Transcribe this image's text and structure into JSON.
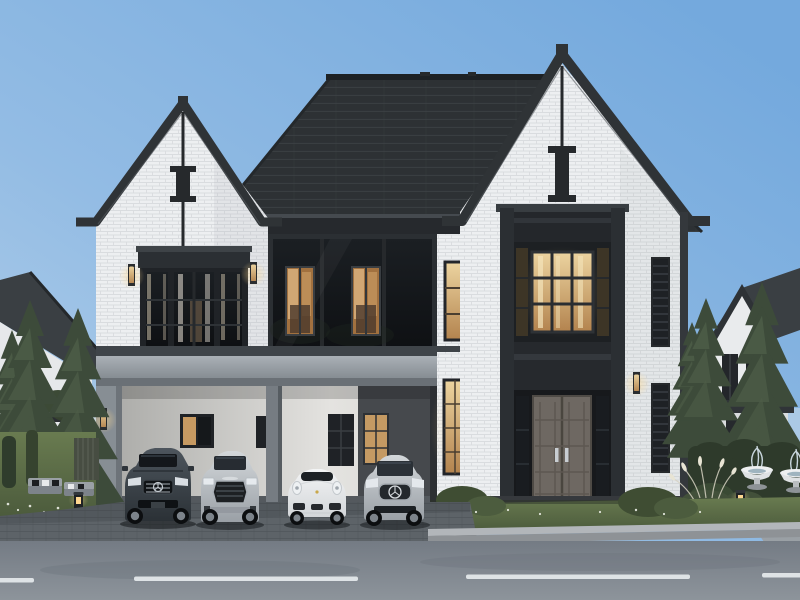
{
  "meta": {
    "description": "Dusk photorealistic 3D exterior rendering of a modern two-story luxury house with white brick walls, charcoal gabled roofs, a glass-walled upper middle section, a lit double-height entrance, and a carport sheltering four cars, fronted by an asphalt road with dashed lane markings",
    "time_of_day": "dusk",
    "render_style": "photorealistic architectural visualization"
  },
  "palette": {
    "sky_light": "#b9d3ea",
    "sky_deep": "#74a9dd",
    "roof": "#2d3134",
    "roof_course": "#3c4145",
    "trim": "#2f3336",
    "brick": "#edeff1",
    "mortar": "#d9dcdf",
    "glass_dark": "#15181c",
    "warm_light": "#d9ae74",
    "warm_bright": "#f0d9a6",
    "fascia": "#9ba1a7",
    "concrete": "#878e94",
    "carport_wall": "#d8d7d4",
    "door": "#6e6862",
    "grass": "#5f7048",
    "grass_dark": "#44533a",
    "pine": "#3d4b3a",
    "pine_light": "#4e5e48",
    "hedge": "#2e3a2b",
    "paver": "#5d6368",
    "road_top": "#747b84",
    "road_bottom": "#8d949b",
    "curb": "#b2b6ba",
    "lane_marking": "#e6eaed",
    "car_dark_gray": "#394046",
    "car_silver": "#b9bec3",
    "car_white": "#e9ebec"
  },
  "scene": {
    "sky": {
      "condition": "clear dusk sky, deeper blue toward upper right"
    },
    "main_house": {
      "floors": 2,
      "walls": "white brick",
      "roof": "charcoal shingle hip roof with two front-facing gables",
      "gable_ornament": "dark vertical post with I-shaped block under each gable peak",
      "upper_middle": "dark glass curtain wall with two warmly lit interior windows",
      "wall_sconces_lit": 6
    },
    "entrance": {
      "style": "double-height gable bay",
      "transom_window": "warm-lit 3x3 grid window",
      "door": "gray paneled double door",
      "handles": 2,
      "sidelights": 2
    },
    "carport": {
      "bays": 4,
      "structure": "flat gray fascia on concrete pillars",
      "back_wall": "light wall with dark-framed windows, darker recess on right"
    },
    "cars": [
      {
        "position": 1,
        "type": "SUV",
        "badge": "three-pointed star",
        "color": "dark gray"
      },
      {
        "position": 2,
        "type": "SUV",
        "badge": "four rings",
        "color": "silver"
      },
      {
        "position": 3,
        "type": "sports coupe",
        "badge": "crest",
        "color": "white"
      },
      {
        "position": 4,
        "type": "hatchback",
        "badge": "three-pointed star",
        "color": "silver"
      }
    ],
    "landscape": {
      "left_garden": [
        "spruce trees",
        "small leafy tree",
        "slatted screen",
        "two outdoor sofas with pillows",
        "bollard light",
        "white flowers in grass"
      ],
      "right_garden": [
        "clipped hedges",
        "two white bowl fountains with jets",
        "ornamental grass plumes",
        "bollard light",
        "spruce trees",
        "stone path"
      ],
      "foreground": [
        "paver driveway",
        "lawn strip with shrubs",
        "light curb",
        "asphalt road"
      ]
    },
    "road": {
      "lane_marking_dashes": 4
    },
    "neighbor_houses": {
      "left": "dark-roofed house partially hidden behind trees",
      "right": "white gable house with dark roof and tall windows"
    }
  }
}
